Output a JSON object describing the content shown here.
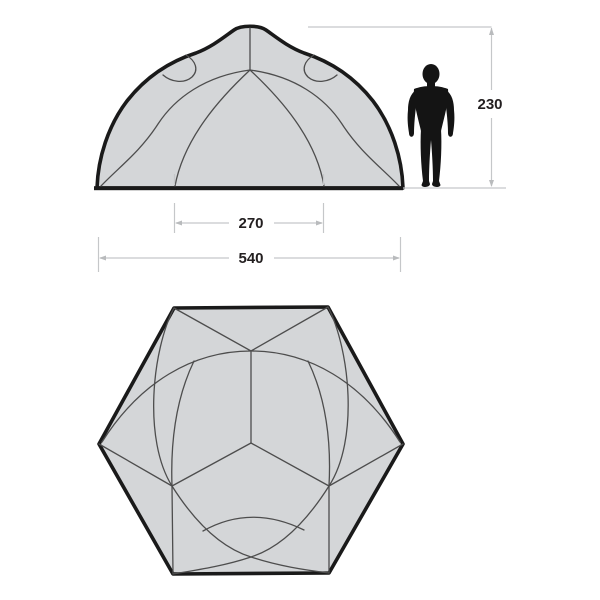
{
  "diagram": {
    "kind": "tent-specification-diagram",
    "dims": {
      "height": "230",
      "inner_width": "270",
      "outer_width": "540"
    },
    "colors": {
      "background": "#ffffff",
      "tent_fill": "#d4d6d8",
      "tent_outline": "#1a1a1a",
      "seam_line": "#4d4d4d",
      "dimension_line": "#c5c7c9",
      "dimension_text": "#231f20",
      "figure_fill": "#141414"
    },
    "icons": {
      "scale_figure": "human-silhouette"
    }
  }
}
